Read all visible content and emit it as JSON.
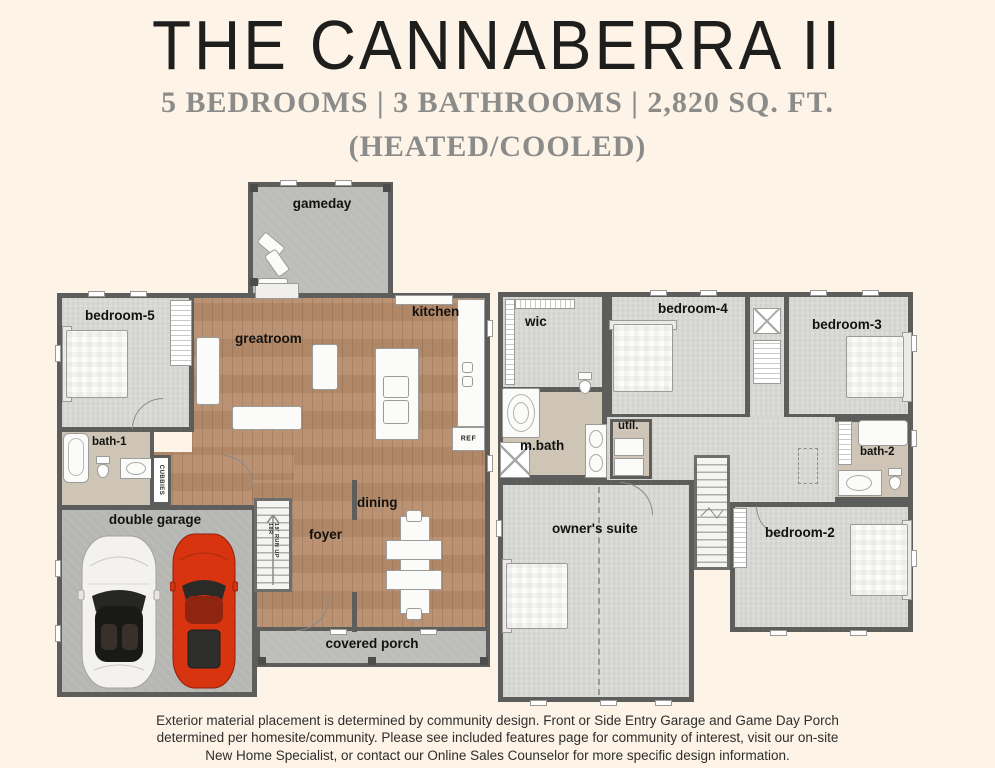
{
  "header": {
    "title": "THE CANNABERRA II",
    "specs": "5 BEDROOMS | 3 BATHROOMS | 2,820 SQ. FT.",
    "heated": "(HEATED/COOLED)"
  },
  "colors": {
    "background": "#fdf3e6",
    "wood_floor": "#b78c6b",
    "carpet": "#d8d8d4",
    "concrete": "#b6b6b3",
    "wall": "#5d5d5b",
    "bath_floor": "#cec5b6",
    "car_red": "#d8340f",
    "car_white": "#f4f2f0"
  },
  "floor1": {
    "rooms": {
      "gameday": "gameday",
      "bedroom5": "bedroom-5",
      "greatroom": "greatroom",
      "kitchen": "kitchen",
      "bath1": "bath-1",
      "cubbies": "CUBBIES",
      "double_garage": "double garage",
      "foyer": "foyer",
      "dining": "dining",
      "covered_porch": "covered porch",
      "ref": "REF",
      "stair_note": "19' RUN UP 18R"
    }
  },
  "floor2": {
    "rooms": {
      "wic": "wic",
      "bedroom4": "bedroom-4",
      "bedroom3": "bedroom-3",
      "mbath": "m.bath",
      "util": "util.",
      "bath2": "bath-2",
      "owners_suite": "owner's suite",
      "bedroom2": "bedroom-2"
    }
  },
  "footer": {
    "line1": "Exterior material placement is determined by community design. Front or Side Entry Garage and Game Day Porch",
    "line2": "determined per homesite/community. Please see included features page for community of interest, visit our on-site",
    "line3": "New Home Specialist, or contact our Online Sales Counselor for more specific design information."
  }
}
